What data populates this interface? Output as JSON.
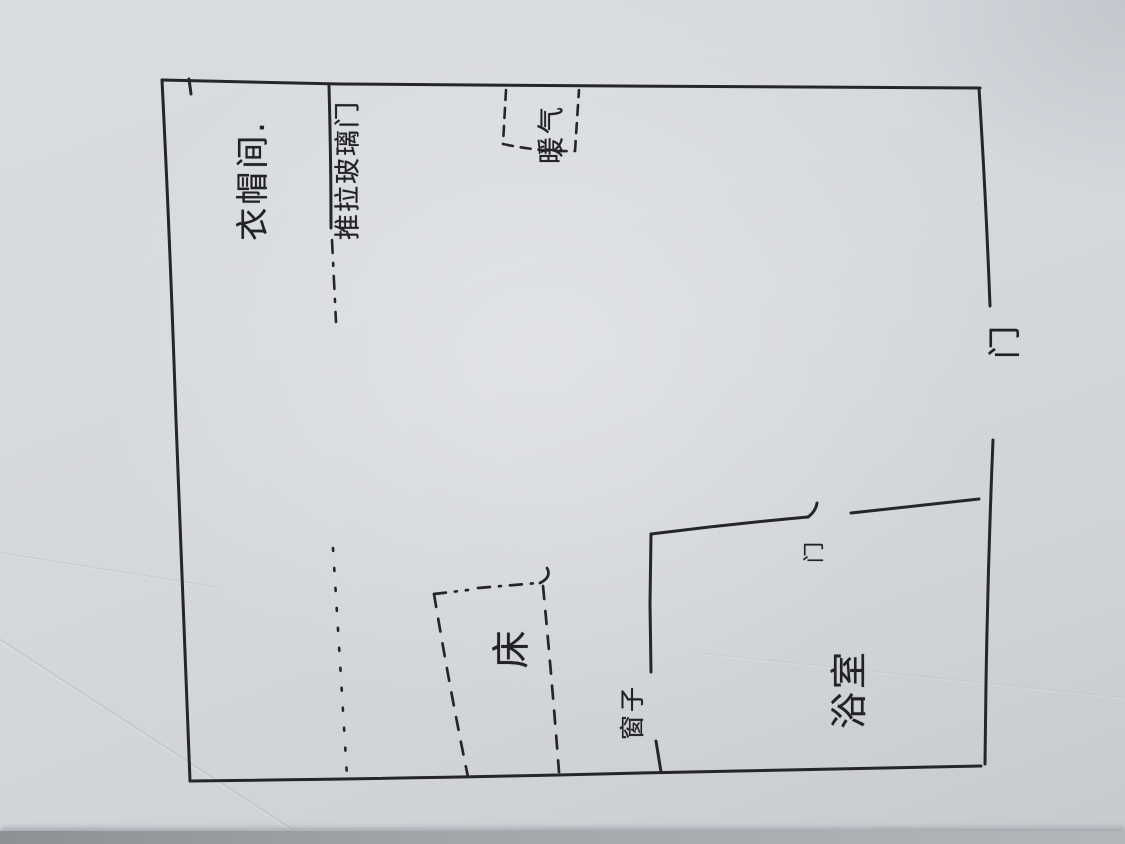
{
  "scene": {
    "paper_color": "#d6d9de",
    "ink_color": "#26262a"
  },
  "labels": {
    "closet_zone": "衣帽间.",
    "sliding_glass_door": "推拉玻璃门",
    "heater": "暖气",
    "entry_door": "门",
    "bed": "床",
    "window": "窗子",
    "bathroom_door": "门",
    "bathroom": "浴室"
  }
}
